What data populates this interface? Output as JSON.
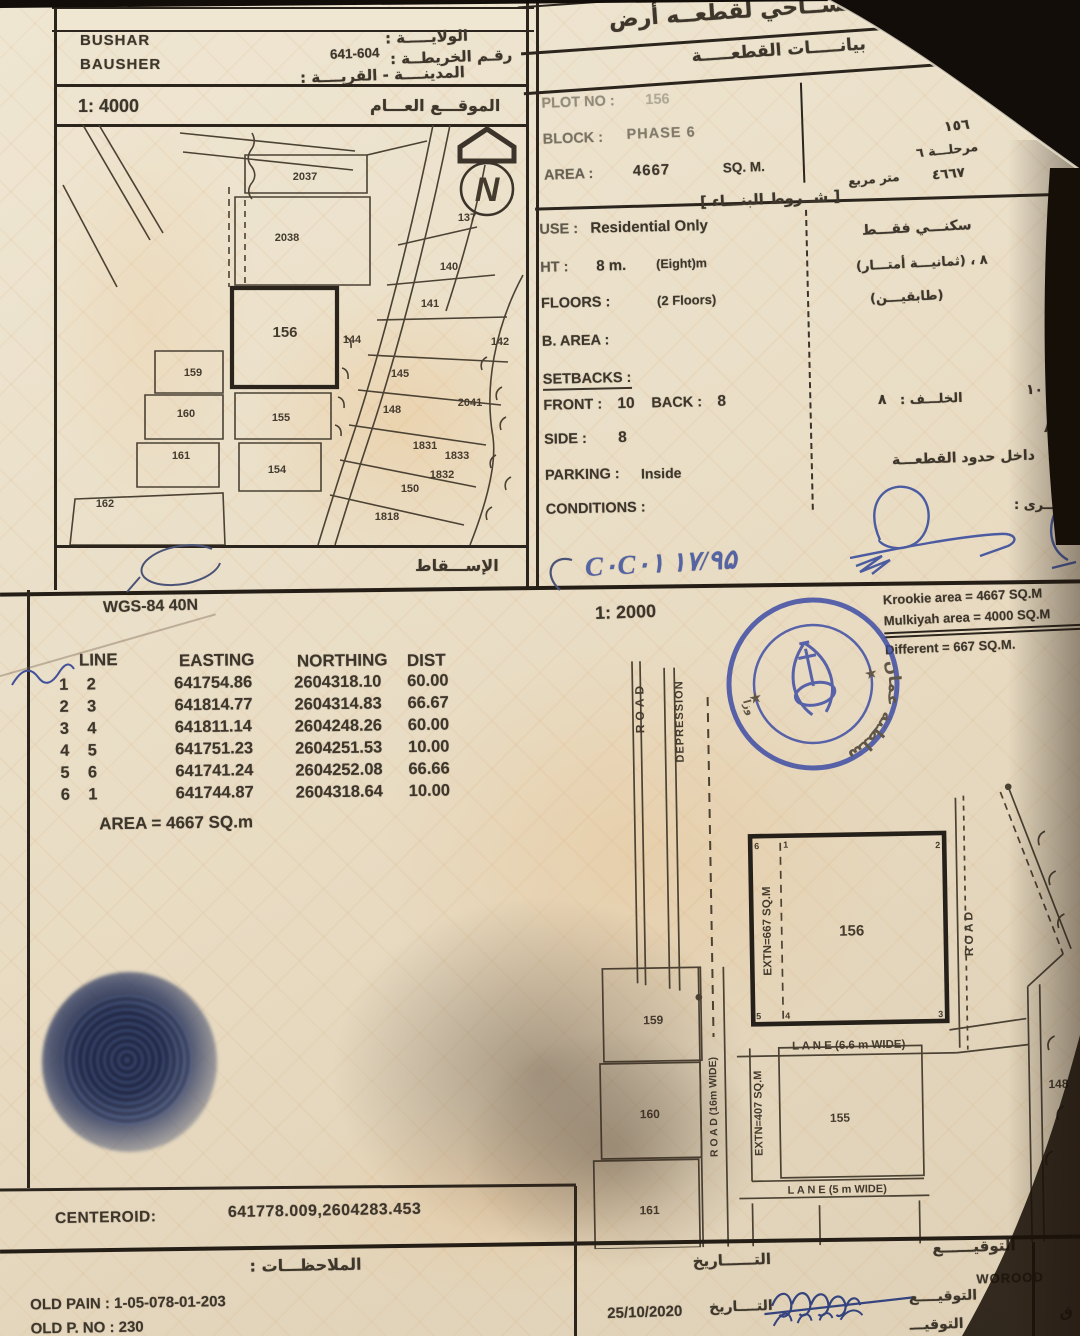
{
  "top": {
    "region1": "BUSHAR",
    "region2": "BAUSHER",
    "wilaya": "الولايـــــة :",
    "map_no_label": "رقـم الخريطــة :",
    "map_no": "641-604",
    "city": "المدينــــة - القريــــة :",
    "title": "رســم مســاحي لقطعــه أرض",
    "subtitle": "بيانـــــات القطعـــــة"
  },
  "overview": {
    "scale": "1: 4000",
    "caption": "الموقـــع العـــام",
    "projection": "الإســـقاط",
    "north": "N",
    "plots": {
      "p2037": "2037",
      "p2038": "2038",
      "p137": "137",
      "p140": "140",
      "p141": "141",
      "p142": "142",
      "p144": "144",
      "p145": "145",
      "p148": "148",
      "p150": "150",
      "p154": "154",
      "p155": "155",
      "p156": "156",
      "p159": "159",
      "p160": "160",
      "p161": "161",
      "p162": "162",
      "p1818": "1818",
      "p1831": "1831",
      "p1832": "1832",
      "p1833": "1833",
      "p2041": "2041"
    }
  },
  "info": {
    "plot_no_label": "PLOT NO :",
    "plot_no": "156",
    "block_label": "BLOCK :",
    "block": "PHASE 6",
    "area_label": "AREA :",
    "area": "4667",
    "area_unit": "SQ. M.",
    "terms_header": "[ شــروط البنـــاء ]",
    "use_label": "USE :",
    "use": "Residential Only",
    "ht_label": "HT :",
    "ht": "8 m.",
    "ht_note": "(Eight)m",
    "floors_label": "FLOORS :",
    "floors": "(2 Floors)",
    "barea_label": "B. AREA :",
    "setbacks_label": "SETBACKS :",
    "front_label": "FRONT :",
    "front": "10",
    "back_label": "BACK :",
    "back": "8",
    "side_label": "SIDE :",
    "side": "8",
    "parking_label": "PARKING :",
    "parking": "Inside",
    "conditions_label": "CONDITIONS :"
  },
  "margin": {
    "plot_no": "١٥٦",
    "phase": "مرحلـــة ٦",
    "area": "٤٦٦٧",
    "area_unit": "متر مربع",
    "use": "سكنـــي فقـــط",
    "height": "٨ ، (ثمانيـــة أمتـــار)",
    "floors": "(طابقيـــن)",
    "back": "الخلـــف :",
    "back_v": "٨",
    "front_v": "١٠",
    "side_v": "٨",
    "parking": "داخل حدود القطعـــة",
    "other": "أخـــرى :"
  },
  "handnote": {
    "note": "C٠C٠۱  ۱۷/۹۵"
  },
  "survey": {
    "datum": "WGS-84  40N",
    "headers": [
      "LINE",
      "EASTING",
      "NORTHING",
      "DIST"
    ],
    "rows": [
      [
        "1",
        "2",
        "641754.86",
        "2604318.10",
        "60.00"
      ],
      [
        "2",
        "3",
        "641814.77",
        "2604314.83",
        "66.67"
      ],
      [
        "3",
        "4",
        "641811.14",
        "2604248.26",
        "60.00"
      ],
      [
        "4",
        "5",
        "641751.23",
        "2604251.53",
        "10.00"
      ],
      [
        "5",
        "6",
        "641741.24",
        "2604252.08",
        "66.66"
      ],
      [
        "6",
        "1",
        "641744.87",
        "2604318.64",
        "10.00"
      ]
    ],
    "area_line": "AREA = 4667  SQ.m"
  },
  "detail": {
    "scale": "1: 2000",
    "krookie": "Krookie   area = 4667 SQ.M",
    "mulkiyah": "Mulkiyah area = 4000 SQ.M",
    "different": "Different          = 667 SQ.M.",
    "road_left": "ROAD",
    "depression": "DEPRESSION",
    "road_right": "ROAD",
    "extn667": "EXTN=667 SQ.M",
    "extn407": "EXTN=407 SQ.M",
    "road16": "R O A D (16m WIDE)",
    "lane66": "L A N E (6.6 m WIDE)",
    "lane5": "L A N E (5 m WIDE)",
    "plots": {
      "p156": "156",
      "p159": "159",
      "p160": "160",
      "p161": "161",
      "p155": "155",
      "p148": "148"
    },
    "corners": {
      "c1": "1",
      "c2": "2",
      "c3": "3",
      "c4": "4",
      "c5": "5",
      "c6": "6"
    }
  },
  "stamp": {
    "top": "سلطنة عمان",
    "bottom": "وزارة الإسكان والتخطيط العمراني"
  },
  "centroid": {
    "label": "CENTEROID:",
    "value": "641778.009,2604283.453"
  },
  "notes": {
    "title": "الملاحظـــات :",
    "old_pain": "OLD PAIN : 1-05-078-01-203",
    "old_pno": "OLD P. NO : 230"
  },
  "sign": {
    "date_header": "التــــــاريخ",
    "sig_header": "التوقيــــــع",
    "name": "WOROOD",
    "sig_label": "التوقيــــع",
    "date_label": "التــــاريخ",
    "date": "25/10/2020",
    "row2_label": "التوقيـــ",
    "row2_tail": "ق"
  }
}
